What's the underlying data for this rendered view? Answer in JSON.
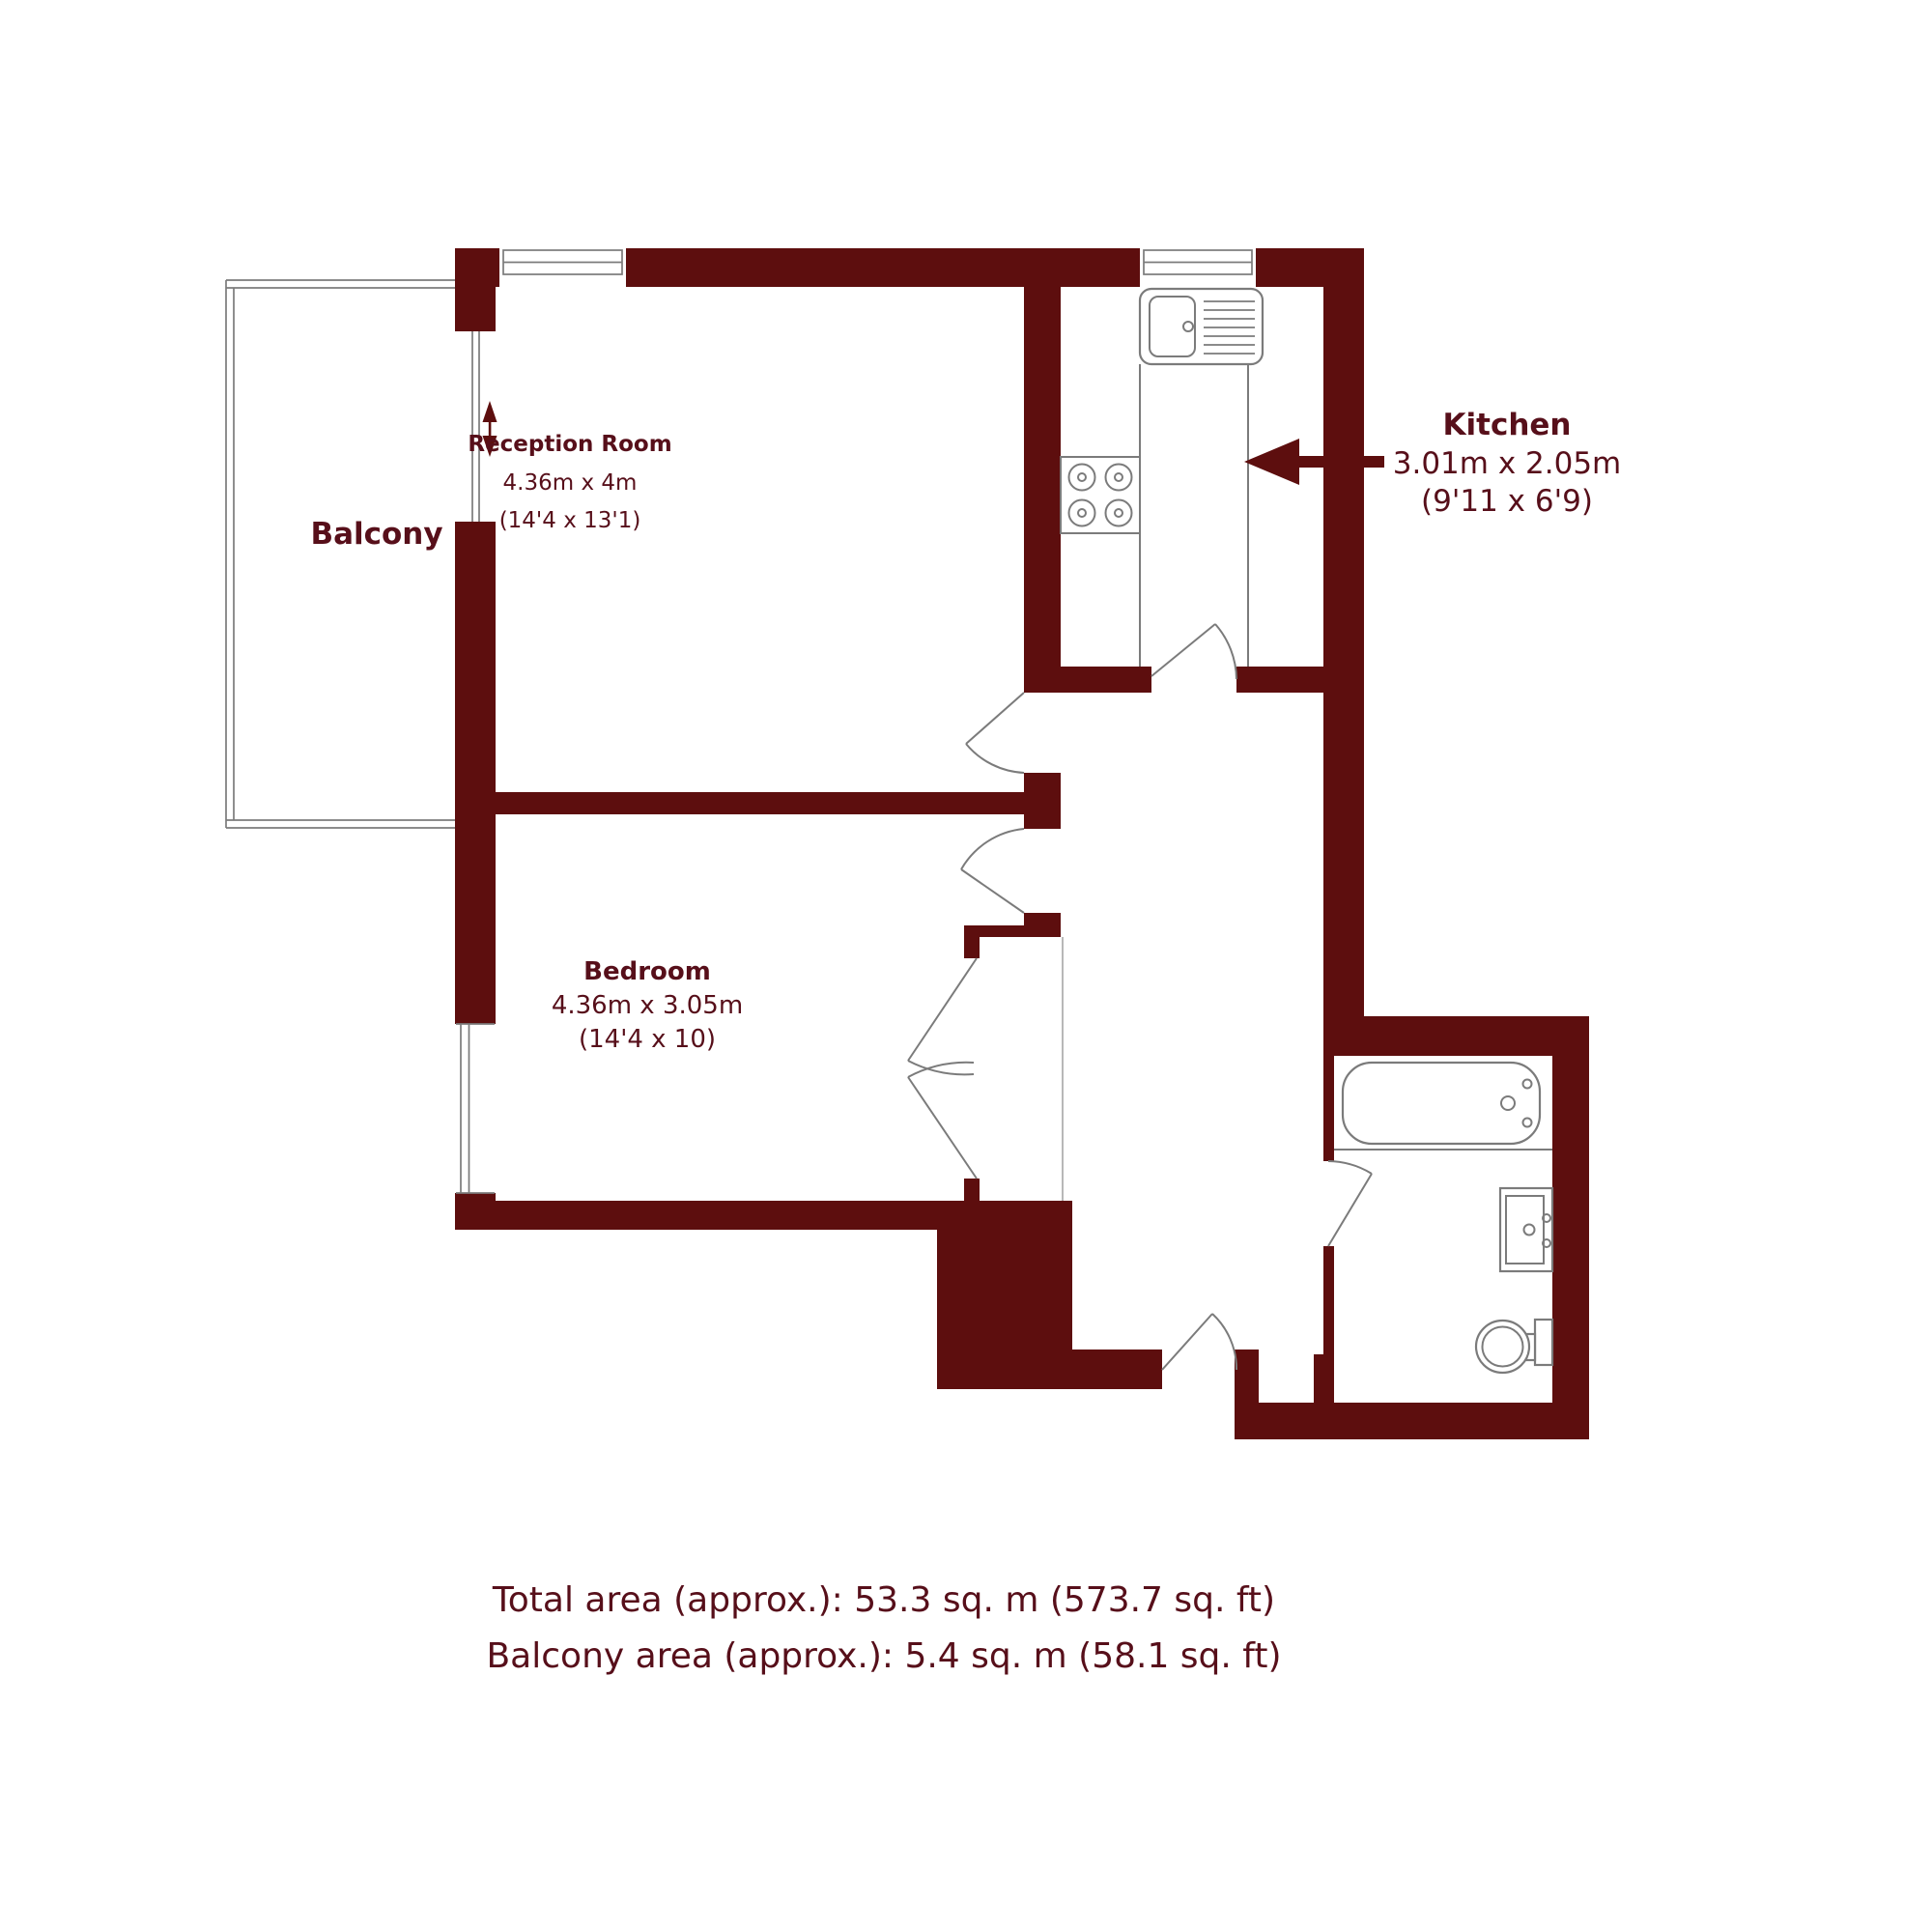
{
  "colors": {
    "wall": "#5d0e0e",
    "label_text": "#570f1a",
    "fixture_outline": "#7b7b7b",
    "background": "#ffffff"
  },
  "plan": {
    "balcony": {
      "label": "Balcony"
    },
    "reception": {
      "label": "Reception Room",
      "size_metric": "4.36m x 4m",
      "size_imperial": "(14'4 x 13'1)"
    },
    "kitchen": {
      "label": "Kitchen",
      "size_metric": "3.01m x 2.05m",
      "size_imperial": "(9'11 x 6'9)"
    },
    "bedroom": {
      "label": "Bedroom",
      "size_metric": "4.36m x 3.05m",
      "size_imperial": "(14'4 x 10)"
    }
  },
  "footer": {
    "total_area": "Total area (approx.): 53.3 sq. m (573.7 sq. ft)",
    "balcony_area": "Balcony area (approx.): 5.4 sq. m (58.1 sq. ft)"
  }
}
